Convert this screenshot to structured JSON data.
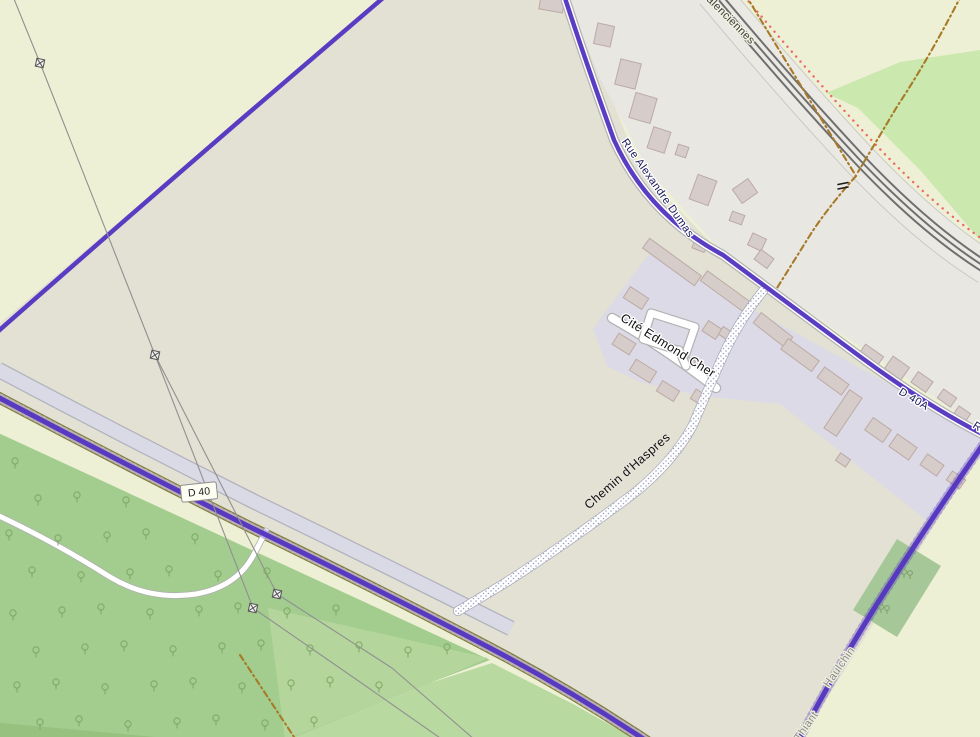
{
  "map": {
    "colors": {
      "base_farmland": "#eef0d5",
      "field": "#e2e1d3",
      "grayzone": "#e9e7e2",
      "residential": "#dcdae6",
      "forest": "#a3cd8e",
      "meadow": "#b8d9a0",
      "meadow2": "#b4d69c",
      "darkstrip": "#97c17f",
      "green_topright": "#cbe8ae",
      "wood_patch": "#a6c898",
      "building_fill": "#d6ccc9",
      "building_stroke": "#bcaaa4",
      "road_casing": "#b3b3b3",
      "road_fill": "#ffffff",
      "d40_casing": "#80803e",
      "d40_fill": "#f2f0ae",
      "boundary_purple": "#5335bf",
      "boundary_orange": "#a87a28",
      "rail_band": "#ebe9e4",
      "rail_edge": "#c6c6c6",
      "rail_track": "#6f6f6f",
      "red_dots": "#ee6a6a",
      "power_line": "#909090",
      "lav_band": "#d9dae6",
      "lav_band_edge": "#b2b2bc",
      "stipple_dot": "#9aa0c4",
      "tree": "#7fa765",
      "path_casing": "#b0b0b0"
    },
    "areas": [
      {
        "name": "field-center",
        "fill": "field",
        "points": "388,-8 570,-8 640,170 723,255 980,440 980,452 800,742 640,742 490,648 250,527 -8,396 -8,330"
      },
      {
        "name": "grayzone-village",
        "fill": "grayzone",
        "points": "565,-8 702,-8 772,66 842,138 902,198 956,248 985,276 985,432 723,253 648,170 600,78"
      },
      {
        "name": "green-topright",
        "fill": "green_topright",
        "points": "826,93 900,62 980,50 980,240 920,170 858,108"
      },
      {
        "name": "forest",
        "fill": "forest",
        "points": "-8,430 490,660 432,682 283,742 -8,742"
      },
      {
        "name": "meadow2",
        "fill": "meadow2",
        "points": "268,608 488,658 428,684 285,740"
      },
      {
        "name": "meadow-bottom",
        "fill": "meadow",
        "points": "492,663 575,705 640,742 283,742 430,683"
      },
      {
        "name": "darkstrip-bottomleft",
        "fill": "darkstrip",
        "points": "-8,722 210,742 -8,742"
      },
      {
        "name": "residential",
        "fill": "residential",
        "points": "593,329 621,291 650,253 980,434 980,446 955,486 930,523 780,404 700,396 640,382 607,366"
      },
      {
        "name": "wood-patch-right",
        "fill": "wood_patch",
        "points": "897,539 941,566 897,637 853,610"
      }
    ],
    "railway": {
      "path": "M712,-8 Q790,85 858,158 Q928,232 990,270",
      "band_width": 34,
      "track_offsets": [
        [
          0,
          0
        ],
        [
          4,
          -4
        ],
        [
          -4,
          4
        ]
      ],
      "edge_offsets": [
        [
          11.9,
          -12.2
        ],
        [
          -11.9,
          12.2
        ]
      ],
      "red_dot_offset": [
        15.4,
        -15.7
      ]
    },
    "lavender_band": {
      "path": "M-8,381 Q120,449 250,514 Q380,577 505,640",
      "translate": [
        6,
        -11.5
      ]
    },
    "roads": [
      {
        "name": "road-d40",
        "path": "M-8,394 Q120,462 250,527 Q380,590 490,648 Q570,690 648,742",
        "casing": "d40_casing",
        "cw": 11.5,
        "fill": "d40_fill",
        "fw": 9
      },
      {
        "name": "road-forest-path",
        "path": "M-5,514 Q55,542 110,577 Q150,601 196,594 Q236,587 253,556 Q260,543 266,531",
        "casing": "path_casing",
        "cw": 6.5,
        "fill": "road_fill",
        "fw": 5
      },
      {
        "name": "road-cite-edmond-cher",
        "path": "M612,318 Q660,345 716,388",
        "casing": "road_casing",
        "cw": 10.5,
        "fill": "road_fill",
        "fw": 8
      },
      {
        "name": "road-cite-loop",
        "path": "M651,313 L695,327 L686,353 L643,339 Z",
        "casing": "road_casing",
        "cw": 9.5,
        "fill": "road_fill",
        "fw": 7
      },
      {
        "name": "road-cite-stem",
        "path": "M679,350 L686,366",
        "casing": "road_casing",
        "cw": 9.5,
        "fill": "road_fill",
        "fw": 7
      },
      {
        "name": "road-rue-alexandre-dumas",
        "path": "M563,-8 Q585,60 614,140 Q648,215 723,255 Q800,312 862,358 Q930,408 990,438",
        "casing": "road_casing",
        "cw": 10,
        "fill": "road_fill",
        "fw": 7.5
      }
    ],
    "chemin": {
      "name": "track-chemin-haspres",
      "path": "M763,291 Q738,322 722,358 Q706,394 693,425 Q670,468 621,503 Q560,548 505,583 Q470,604 458,611",
      "width": 8.5
    },
    "purple_boundaries": [
      {
        "name": "boundary-nw",
        "path": "M390,-8 L244,117 Q120,224 -5,334",
        "w": 4.5,
        "serrate": false
      },
      {
        "name": "boundary-on-dumas",
        "path": "M563,-8 Q585,60 614,140 Q648,215 723,255 Q800,312 862,358 Q930,408 990,438",
        "w": 4.5,
        "serrate": false
      },
      {
        "name": "boundary-on-d40",
        "path": "M-8,394 Q120,462 250,527 Q380,590 490,648 Q570,690 648,742",
        "w": 5,
        "serrate": true
      },
      {
        "name": "boundary-se",
        "path": "M982,446 Q930,520 872,612 Q830,680 798,742",
        "w": 5,
        "serrate": true
      }
    ],
    "orange_boundaries": [
      {
        "path": "M745,-6 L856,176"
      },
      {
        "path": "M962,-6 Q928,60 898,105 L858,172"
      },
      {
        "path": "M856,176 Q830,205 812,232 L777,288"
      },
      {
        "path": "M240,655 L296,740"
      }
    ],
    "power_lines": {
      "lines": [
        "M12,-6 L40,63 L155,355 L253,608 L360,682 L443,740",
        "M155,355 L277,594 L392,668 L475,740"
      ],
      "pylons": [
        [
          40,
          63
        ],
        [
          155,
          355
        ],
        [
          253,
          608
        ],
        [
          277,
          594
        ]
      ]
    },
    "buildings": [
      [
        552,
        3,
        24,
        16,
        10
      ],
      [
        604,
        35,
        17,
        21,
        12
      ],
      [
        628,
        74,
        21,
        26,
        14
      ],
      [
        643,
        108,
        22,
        26,
        16
      ],
      [
        659,
        140,
        18,
        22,
        18
      ],
      [
        682,
        151,
        11,
        11,
        18
      ],
      [
        703,
        190,
        20,
        26,
        20
      ],
      [
        745,
        191,
        17,
        19,
        55
      ],
      [
        737,
        218,
        13,
        10,
        20
      ],
      [
        757,
        242,
        15,
        13,
        25
      ],
      [
        700,
        245,
        13,
        11,
        22
      ],
      [
        764,
        259,
        16,
        12,
        36
      ],
      [
        672,
        262,
        64,
        12,
        36
      ],
      [
        725,
        291,
        52,
        12,
        36
      ],
      [
        636,
        298,
        22,
        13,
        33
      ],
      [
        624,
        344,
        20,
        13,
        32
      ],
      [
        643,
        371,
        24,
        13,
        32
      ],
      [
        668,
        391,
        20,
        12,
        32
      ],
      [
        700,
        398,
        16,
        11,
        32
      ],
      [
        712,
        330,
        16,
        12,
        33
      ],
      [
        725,
        333,
        10,
        9,
        33
      ],
      [
        688,
        362,
        12,
        9,
        33
      ],
      [
        773,
        330,
        40,
        13,
        38
      ],
      [
        800,
        355,
        38,
        13,
        36
      ],
      [
        833,
        381,
        30,
        13,
        36
      ],
      [
        843,
        413,
        15,
        46,
        34
      ],
      [
        870,
        357,
        22,
        16,
        35
      ],
      [
        897,
        368,
        20,
        15,
        35
      ],
      [
        922,
        382,
        18,
        13,
        35
      ],
      [
        947,
        398,
        16,
        11,
        35
      ],
      [
        962,
        414,
        14,
        10,
        35
      ],
      [
        878,
        430,
        22,
        15,
        35
      ],
      [
        903,
        447,
        24,
        15,
        35
      ],
      [
        932,
        465,
        20,
        13,
        35
      ],
      [
        956,
        480,
        16,
        11,
        35
      ],
      [
        843,
        460,
        12,
        9,
        35
      ]
    ],
    "tree_pattern": {
      "x0": -10,
      "y0": 425,
      "dx": 46,
      "dy": 37,
      "stagger": 23,
      "xmax": 540,
      "ymax": 740
    },
    "tree_pairs": [
      [
        907,
        572
      ],
      [
        884,
        607
      ]
    ],
    "level_crossing": {
      "x": 843,
      "y": 186
    },
    "badge": {
      "text": "D 40",
      "x": 199,
      "y": 492,
      "w": 36,
      "h": 17,
      "rot": -6,
      "bg": "#fdfdf2",
      "border": "#8f8f8f",
      "color": "#222222"
    },
    "labels": [
      {
        "id": "label-valenciennes",
        "text": "Valenciennes",
        "x": 726,
        "y": 20,
        "rot": 45,
        "size": 11,
        "color": "#3c3c3c",
        "halo": "#f2f2e2"
      },
      {
        "id": "label-rue-alexandre-dumas",
        "text": "Rue Alexandre Dumas",
        "x": 655,
        "y": 190,
        "rot": 55,
        "size": 11,
        "color": "#17175c",
        "halo": "#ffffff"
      },
      {
        "id": "label-cite-edmond-cher",
        "text": "Cité Edmond Cher",
        "x": 666,
        "y": 349,
        "rot": 32,
        "size": 12.5,
        "color": "#101010",
        "halo": "#ffffff"
      },
      {
        "id": "label-chemin-haspres",
        "text": "Chemin d'Haspres",
        "x": 630,
        "y": 474,
        "rot": -41,
        "size": 12.5,
        "color": "#101010",
        "halo": "#e6e4da"
      },
      {
        "id": "label-d40a",
        "text": "D 40A",
        "x": 912,
        "y": 402,
        "rot": 31,
        "size": 11,
        "color": "#17175c",
        "halo": "#ffffff"
      },
      {
        "id": "label-rue-clipped",
        "text": "Rue",
        "x": 981,
        "y": 433,
        "rot": 33,
        "size": 11,
        "color": "#17175c",
        "halo": "#ffffff"
      },
      {
        "id": "label-haulchin",
        "text": "Haulchin",
        "x": 842,
        "y": 669,
        "rot": -55,
        "size": 11,
        "color": "#8a8a8a",
        "halo": "#eeeedd"
      },
      {
        "id": "label-thiant",
        "text": "Thiant",
        "x": 809,
        "y": 728,
        "rot": -55,
        "size": 11,
        "color": "#8a8a8a",
        "halo": "#eeeedd"
      }
    ]
  }
}
